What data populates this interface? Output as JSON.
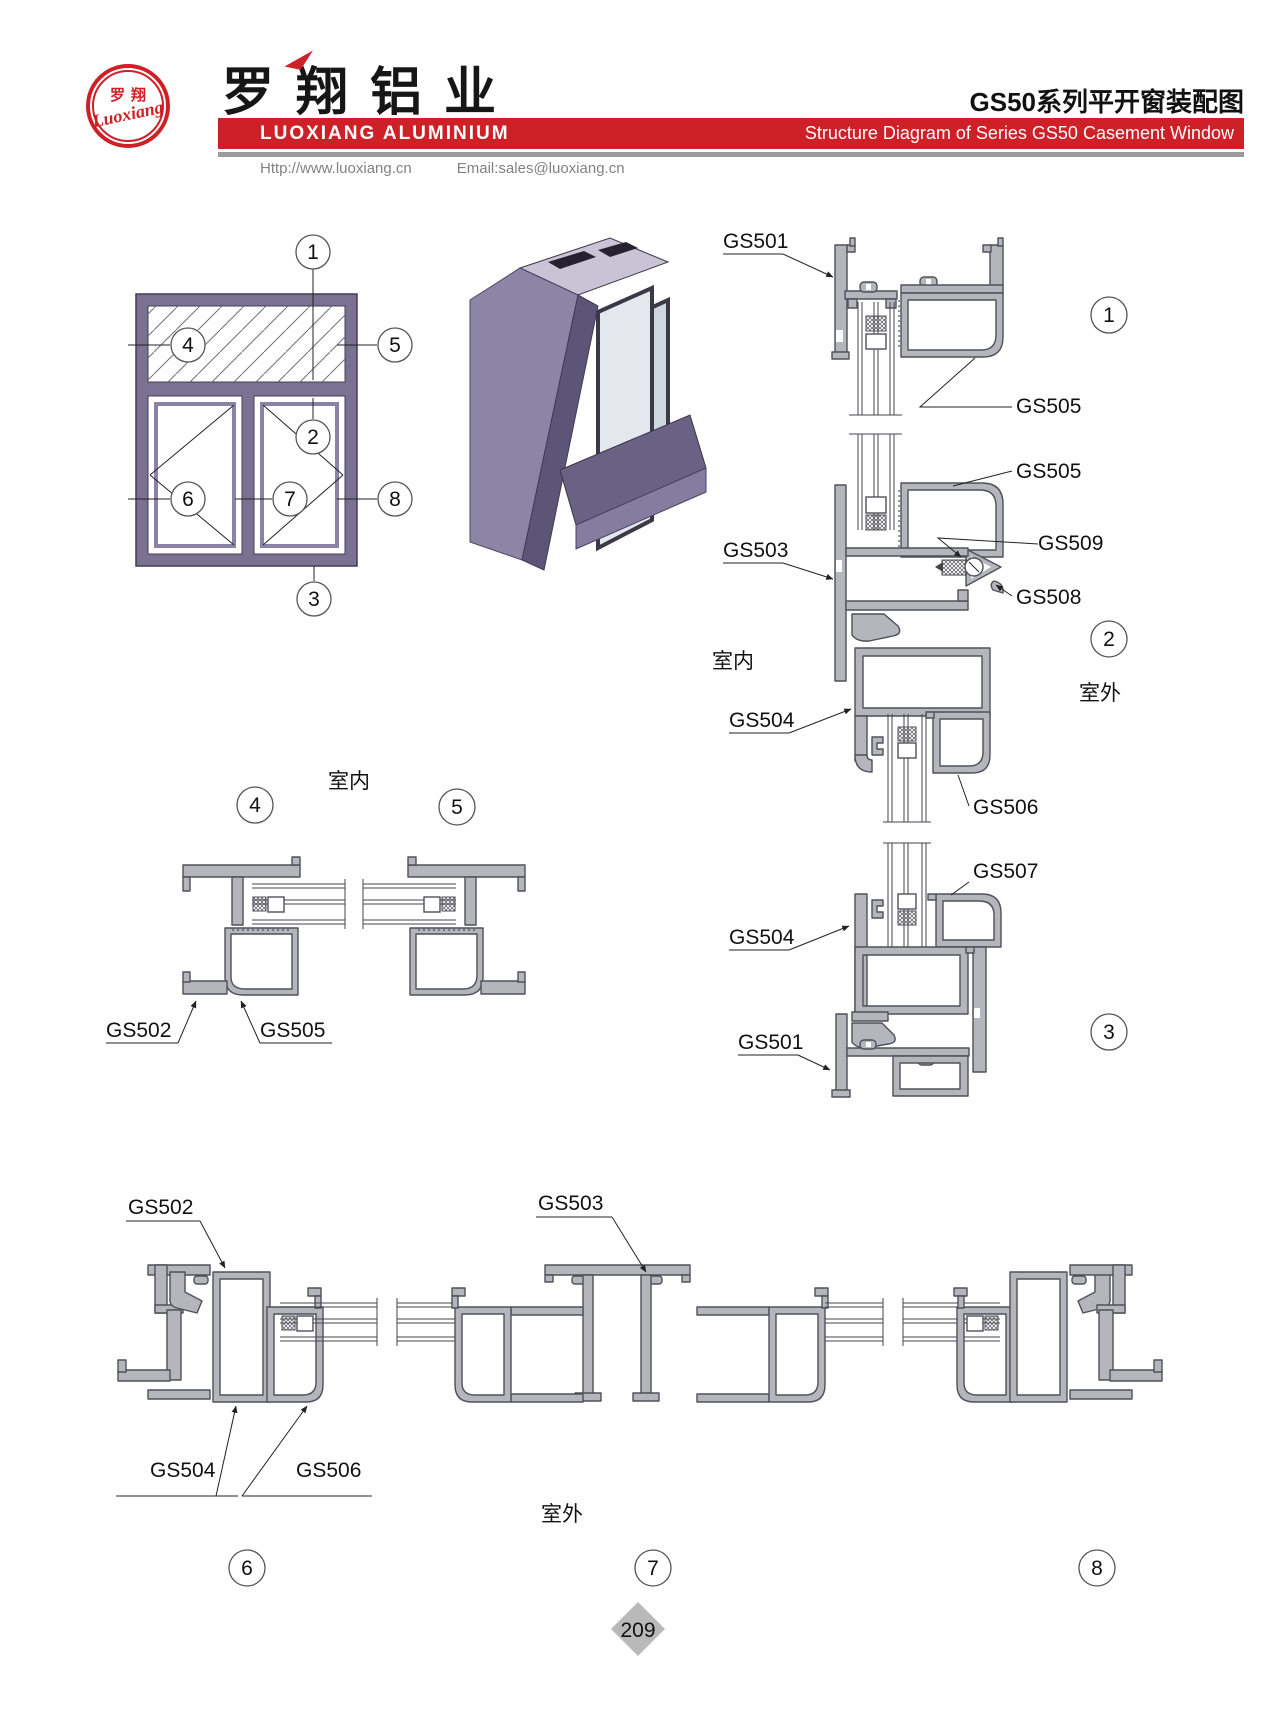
{
  "header": {
    "logo_cn": "罗翔",
    "logo_script": "Luoxiang",
    "company_cn": "罗翔铝业",
    "company_en": "LUOXIANG ALUMINIUM",
    "title_cn": "GS50系列平开窗装配图",
    "title_en": "Structure Diagram of Series GS50 Casement Window",
    "website": "Http://www.luoxiang.cn",
    "email": "Email:sales@luoxiang.cn"
  },
  "colors": {
    "brand_red": "#ce2127",
    "profile_purple": "#7b7292",
    "aluminum_gray": "#b5b5bc",
    "line_dark": "#50505a",
    "page_diamond": "#b9b9b9"
  },
  "labels": {
    "gs501": "GS501",
    "gs502": "GS502",
    "gs503": "GS503",
    "gs504": "GS504",
    "gs505": "GS505",
    "gs506": "GS506",
    "gs507": "GS507",
    "gs508": "GS508",
    "gs509": "GS509",
    "room_inside": "室内",
    "room_outside": "室外"
  },
  "callouts": {
    "c1": "1",
    "c2": "2",
    "c3": "3",
    "c4": "4",
    "c5": "5",
    "c6": "6",
    "c7": "7",
    "c8": "8"
  },
  "footer": {
    "page_number": "209"
  }
}
